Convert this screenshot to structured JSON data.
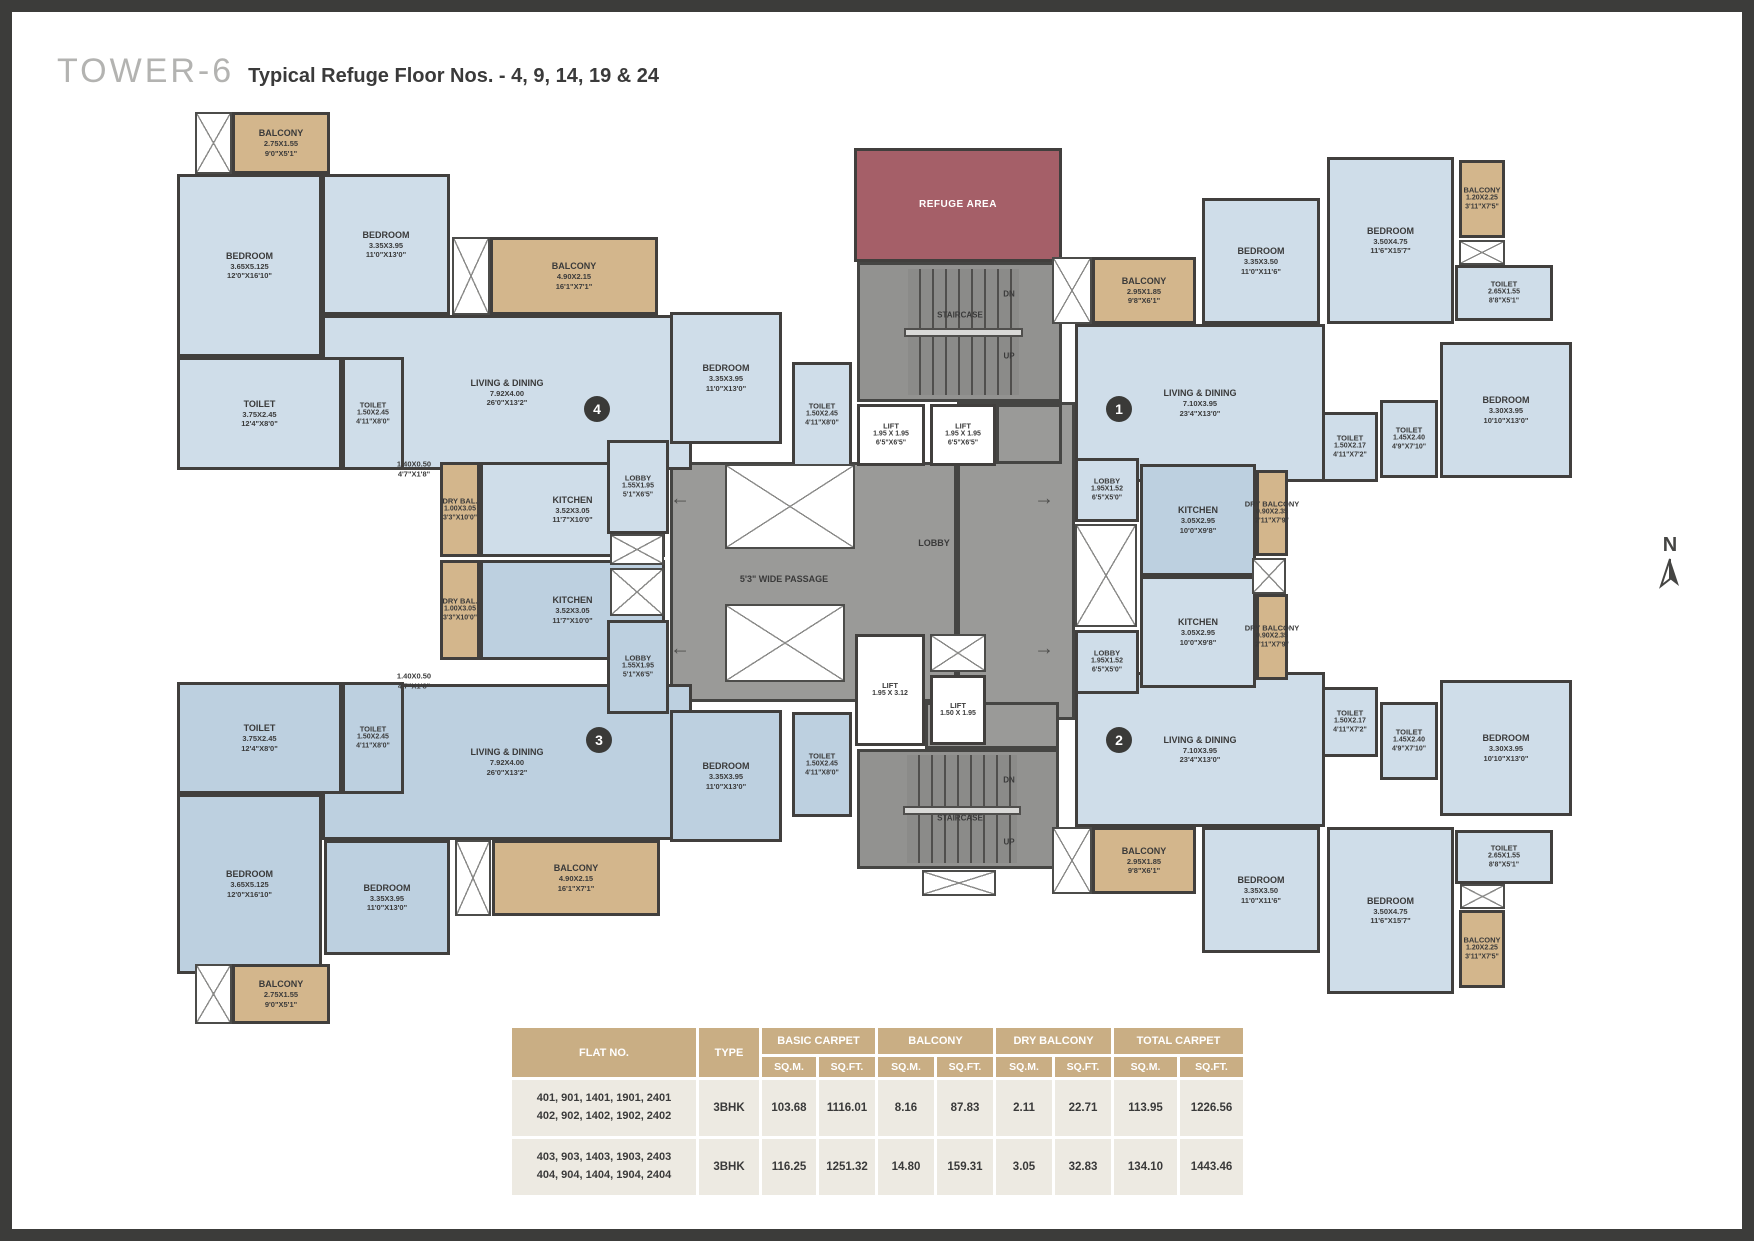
{
  "title": {
    "tower": "TOWER-6",
    "subtitle": "Typical Refuge Floor Nos. - 4, 9, 14, 19 & 24"
  },
  "compass": {
    "label": "N"
  },
  "palette": {
    "room_light": "#cfdde9",
    "room_dark": "#bdd0e0",
    "balcony": "#d3b68c",
    "refuge": "#a55f68",
    "lobby_gray": "#9a9a98",
    "wall": "#413f3d",
    "table_header": "#c9ae84",
    "table_cell": "#edeae2"
  },
  "plan": {
    "shapes": [
      {
        "id": "central-passage",
        "t": "gray",
        "x": 658,
        "y": 450,
        "w": 287,
        "h": 240
      },
      {
        "id": "lobby-column",
        "t": "gray",
        "x": 945,
        "y": 390,
        "w": 118,
        "h": 318
      },
      {
        "id": "gray-patch-lift",
        "t": "gray",
        "x": 984,
        "y": 392,
        "w": 66,
        "h": 60
      },
      {
        "id": "gray-patch-lower",
        "t": "gray",
        "x": 913,
        "y": 690,
        "w": 134,
        "h": 47
      },
      {
        "id": "staircase-top",
        "t": "stair",
        "x": 845,
        "y": 250,
        "w": 205,
        "h": 140
      },
      {
        "id": "staircase-bottom",
        "t": "stair",
        "x": 845,
        "y": 737,
        "w": 202,
        "h": 120
      },
      {
        "id": "refuge-area",
        "t": "ref",
        "n": "REFUGE AREA",
        "x": 842,
        "y": 136,
        "w": 208,
        "h": 114
      },
      {
        "id": "living-4",
        "t": "a",
        "n": "LIVING & DINING",
        "d1": "7.92X4.00",
        "d2": "26'0\"X13'2\"",
        "x": 310,
        "y": 303,
        "w": 370,
        "h": 155
      },
      {
        "id": "living-3",
        "t": "b",
        "n": "LIVING & DINING",
        "d1": "7.92X4.00",
        "d2": "26'0\"X13'2\"",
        "x": 310,
        "y": 672,
        "w": 370,
        "h": 156
      },
      {
        "id": "living-1",
        "t": "a",
        "n": "LIVING & DINING",
        "d1": "7.10X3.95",
        "d2": "23'4\"X13'0\"",
        "x": 1063,
        "y": 312,
        "w": 250,
        "h": 158
      },
      {
        "id": "living-2",
        "t": "a",
        "n": "LIVING & DINING",
        "d1": "7.10X3.95",
        "d2": "23'4\"X13'0\"",
        "x": 1063,
        "y": 660,
        "w": 250,
        "h": 155
      },
      {
        "id": "balcony-4a",
        "t": "bal",
        "n": "BALCONY",
        "d1": "2.75X1.55",
        "d2": "9'0\"X5'1\"",
        "x": 220,
        "y": 100,
        "w": 98,
        "h": 62
      },
      {
        "id": "bedroom-4a",
        "t": "a",
        "n": "BEDROOM",
        "d1": "3.65X5.125",
        "d2": "12'0\"X16'10\"",
        "x": 165,
        "y": 162,
        "w": 145,
        "h": 183
      },
      {
        "id": "bedroom-4b",
        "t": "a",
        "n": "BEDROOM",
        "d1": "3.35X3.95",
        "d2": "11'0\"X13'0\"",
        "x": 310,
        "y": 162,
        "w": 128,
        "h": 141
      },
      {
        "id": "balcony-4b",
        "t": "bal",
        "n": "BALCONY",
        "d1": "4.90X2.15",
        "d2": "16'1\"X7'1\"",
        "x": 478,
        "y": 225,
        "w": 168,
        "h": 78
      },
      {
        "id": "toilet-4a",
        "t": "a",
        "n": "TOILET",
        "d1": "3.75X2.45",
        "d2": "12'4\"X8'0\"",
        "x": 165,
        "y": 345,
        "w": 165,
        "h": 113
      },
      {
        "id": "toilet-4b",
        "t": "a",
        "sm": 1,
        "n": "TOILET",
        "d1": "1.50X2.45",
        "d2": "4'11\"X8'0\"",
        "x": 330,
        "y": 345,
        "w": 62,
        "h": 113
      },
      {
        "id": "drybal-4",
        "t": "bal",
        "sm": 1,
        "n": "DRY BAL.",
        "d1": "1.00X3.05",
        "d2": "3'3\"X10'0\"",
        "x": 428,
        "y": 450,
        "w": 40,
        "h": 95
      },
      {
        "id": "kitchen-4",
        "t": "a",
        "n": "KITCHEN",
        "d1": "3.52X3.05",
        "d2": "11'7\"X10'0\"",
        "x": 468,
        "y": 450,
        "w": 185,
        "h": 95
      },
      {
        "id": "lobby-4",
        "t": "a",
        "sm": 1,
        "n": "LOBBY",
        "d1": "1.55X1.95",
        "d2": "5'1\"X6'5\"",
        "x": 595,
        "y": 428,
        "w": 62,
        "h": 94
      },
      {
        "id": "bedroom-4c",
        "t": "a",
        "n": "BEDROOM",
        "d1": "3.35X3.95",
        "d2": "11'0\"X13'0\"",
        "x": 658,
        "y": 300,
        "w": 112,
        "h": 132
      },
      {
        "id": "toilet-4c",
        "t": "a",
        "sm": 1,
        "n": "TOILET",
        "d1": "1.50X2.45",
        "d2": "4'11\"X8'0\"",
        "x": 780,
        "y": 350,
        "w": 60,
        "h": 105
      },
      {
        "id": "toilet-3a",
        "t": "b",
        "n": "TOILET",
        "d1": "3.75X2.45",
        "d2": "12'4\"X8'0\"",
        "x": 165,
        "y": 670,
        "w": 165,
        "h": 112
      },
      {
        "id": "toilet-3b",
        "t": "b",
        "sm": 1,
        "n": "TOILET",
        "d1": "1.50X2.45",
        "d2": "4'11\"X8'0\"",
        "x": 330,
        "y": 670,
        "w": 62,
        "h": 112
      },
      {
        "id": "drybal-3",
        "t": "bal",
        "sm": 1,
        "n": "DRY BAL.",
        "d1": "1.00X3.05",
        "d2": "3'3\"X10'0\"",
        "x": 428,
        "y": 548,
        "w": 40,
        "h": 100
      },
      {
        "id": "kitchen-3",
        "t": "b",
        "n": "KITCHEN",
        "d1": "3.52X3.05",
        "d2": "11'7\"X10'0\"",
        "x": 468,
        "y": 548,
        "w": 185,
        "h": 100
      },
      {
        "id": "lobby-3",
        "t": "b",
        "sm": 1,
        "n": "LOBBY",
        "d1": "1.55X1.95",
        "d2": "5'1\"X6'5\"",
        "x": 595,
        "y": 608,
        "w": 62,
        "h": 94
      },
      {
        "id": "bedroom-3c",
        "t": "b",
        "n": "BEDROOM",
        "d1": "3.35X3.95",
        "d2": "11'0\"X13'0\"",
        "x": 658,
        "y": 698,
        "w": 112,
        "h": 132
      },
      {
        "id": "toilet-3c",
        "t": "b",
        "sm": 1,
        "n": "TOILET",
        "d1": "1.50X2.45",
        "d2": "4'11\"X8'0\"",
        "x": 780,
        "y": 700,
        "w": 60,
        "h": 105
      },
      {
        "id": "bedroom-3a",
        "t": "b",
        "n": "BEDROOM",
        "d1": "3.65X5.125",
        "d2": "12'0\"X16'10\"",
        "x": 165,
        "y": 782,
        "w": 145,
        "h": 180
      },
      {
        "id": "bedroom-3b",
        "t": "b",
        "n": "BEDROOM",
        "d1": "3.35X3.95",
        "d2": "11'0\"X13'0\"",
        "x": 312,
        "y": 828,
        "w": 126,
        "h": 115
      },
      {
        "id": "balcony-3b",
        "t": "bal",
        "n": "BALCONY",
        "d1": "4.90X2.15",
        "d2": "16'1\"X7'1\"",
        "x": 480,
        "y": 828,
        "w": 168,
        "h": 76
      },
      {
        "id": "balcony-3a",
        "t": "bal",
        "n": "BALCONY",
        "d1": "2.75X1.55",
        "d2": "9'0\"X5'1\"",
        "x": 220,
        "y": 952,
        "w": 98,
        "h": 60
      },
      {
        "id": "balcony-1a",
        "t": "bal",
        "n": "BALCONY",
        "d1": "2.95X1.85",
        "d2": "9'8\"X6'1\"",
        "x": 1080,
        "y": 245,
        "w": 104,
        "h": 67
      },
      {
        "id": "bedroom-1a",
        "t": "a",
        "n": "BEDROOM",
        "d1": "3.35X3.50",
        "d2": "11'0\"X11'6\"",
        "x": 1190,
        "y": 186,
        "w": 118,
        "h": 126
      },
      {
        "id": "bedroom-1b",
        "t": "a",
        "n": "BEDROOM",
        "d1": "3.50X4.75",
        "d2": "11'6\"X15'7\"",
        "x": 1315,
        "y": 145,
        "w": 127,
        "h": 167
      },
      {
        "id": "balcony-1b",
        "t": "bal",
        "sm": 1,
        "n": "BALCONY",
        "d1": "1.20X2.25",
        "d2": "3'11\"X7'5\"",
        "x": 1447,
        "y": 148,
        "w": 46,
        "h": 78
      },
      {
        "id": "toilet-1c",
        "t": "a",
        "sm": 1,
        "n": "TOILET",
        "d1": "2.65X1.55",
        "d2": "8'8\"X5'1\"",
        "x": 1443,
        "y": 253,
        "w": 98,
        "h": 56
      },
      {
        "id": "toilet-1a",
        "t": "a",
        "sm": 1,
        "n": "TOILET",
        "d1": "1.50X2.17",
        "d2": "4'11\"X7'2\"",
        "x": 1310,
        "y": 400,
        "w": 56,
        "h": 70
      },
      {
        "id": "toilet-1b",
        "t": "a",
        "sm": 1,
        "n": "TOILET",
        "d1": "1.45X2.40",
        "d2": "4'9\"X7'10\"",
        "x": 1368,
        "y": 388,
        "w": 58,
        "h": 78
      },
      {
        "id": "bedroom-1c",
        "t": "a",
        "n": "BEDROOM",
        "d1": "3.30X3.95",
        "d2": "10'10\"X13'0\"",
        "x": 1428,
        "y": 330,
        "w": 132,
        "h": 136
      },
      {
        "id": "kitchen-1",
        "t": "b",
        "n": "KITCHEN",
        "d1": "3.05X2.95",
        "d2": "10'0\"X9'8\"",
        "x": 1128,
        "y": 452,
        "w": 116,
        "h": 112
      },
      {
        "id": "lobby-1",
        "t": "a",
        "sm": 1,
        "n": "LOBBY",
        "d1": "1.95X1.52",
        "d2": "6'5\"X5'0\"",
        "x": 1063,
        "y": 446,
        "w": 64,
        "h": 64
      },
      {
        "id": "drybal-1",
        "t": "bal",
        "sm": 1,
        "n": "DRY BALCONY",
        "d1": "0.90X2.35",
        "d2": "2'11\"X7'9\"",
        "x": 1244,
        "y": 458,
        "w": 32,
        "h": 86
      },
      {
        "id": "kitchen-2",
        "t": "a",
        "n": "KITCHEN",
        "d1": "3.05X2.95",
        "d2": "10'0\"X9'8\"",
        "x": 1128,
        "y": 564,
        "w": 116,
        "h": 112
      },
      {
        "id": "lobby-2",
        "t": "a",
        "sm": 1,
        "n": "LOBBY",
        "d1": "1.95X1.52",
        "d2": "6'5\"X5'0\"",
        "x": 1063,
        "y": 618,
        "w": 64,
        "h": 64
      },
      {
        "id": "drybal-2",
        "t": "bal",
        "sm": 1,
        "n": "DRY BALCONY",
        "d1": "0.90X2.35",
        "d2": "2'11\"X7'9\"",
        "x": 1244,
        "y": 582,
        "w": 32,
        "h": 86
      },
      {
        "id": "toilet-2a",
        "t": "a",
        "sm": 1,
        "n": "TOILET",
        "d1": "1.50X2.17",
        "d2": "4'11\"X7'2\"",
        "x": 1310,
        "y": 675,
        "w": 56,
        "h": 70
      },
      {
        "id": "toilet-2b",
        "t": "a",
        "sm": 1,
        "n": "TOILET",
        "d1": "1.45X2.40",
        "d2": "4'9\"X7'10\"",
        "x": 1368,
        "y": 690,
        "w": 58,
        "h": 78
      },
      {
        "id": "bedroom-2c",
        "t": "a",
        "n": "BEDROOM",
        "d1": "3.30X3.95",
        "d2": "10'10\"X13'0\"",
        "x": 1428,
        "y": 668,
        "w": 132,
        "h": 136
      },
      {
        "id": "balcony-2a",
        "t": "bal",
        "n": "BALCONY",
        "d1": "2.95X1.85",
        "d2": "9'8\"X6'1\"",
        "x": 1080,
        "y": 815,
        "w": 104,
        "h": 67
      },
      {
        "id": "bedroom-2a",
        "t": "a",
        "n": "BEDROOM",
        "d1": "3.35X3.50",
        "d2": "11'0\"X11'6\"",
        "x": 1190,
        "y": 815,
        "w": 118,
        "h": 126
      },
      {
        "id": "bedroom-2b",
        "t": "a",
        "n": "BEDROOM",
        "d1": "3.50X4.75",
        "d2": "11'6\"X15'7\"",
        "x": 1315,
        "y": 815,
        "w": 127,
        "h": 167
      },
      {
        "id": "toilet-2c",
        "t": "a",
        "sm": 1,
        "n": "TOILET",
        "d1": "2.65X1.55",
        "d2": "8'8\"X5'1\"",
        "x": 1443,
        "y": 818,
        "w": 98,
        "h": 54
      },
      {
        "id": "balcony-2b",
        "t": "bal",
        "sm": 1,
        "n": "BALCONY",
        "d1": "1.20X2.25",
        "d2": "3'11\"X7'5\"",
        "x": 1447,
        "y": 898,
        "w": 46,
        "h": 78
      },
      {
        "id": "lift-1",
        "t": "lift",
        "sm": 1,
        "n": "LIFT",
        "d1": "1.95 X 1.95",
        "d2": "6'5\"X6'5\"",
        "x": 845,
        "y": 392,
        "w": 68,
        "h": 62
      },
      {
        "id": "lift-2",
        "t": "lift",
        "sm": 1,
        "n": "LIFT",
        "d1": "1.95 X 1.95",
        "d2": "6'5\"X6'5\"",
        "x": 918,
        "y": 392,
        "w": 66,
        "h": 62
      },
      {
        "id": "lift-3",
        "t": "lift",
        "sm": 1,
        "n": "LIFT",
        "d1": "1.95 X 3.12",
        "x": 843,
        "y": 622,
        "w": 70,
        "h": 112
      },
      {
        "id": "lift-4",
        "t": "lift",
        "sm": 1,
        "n": "LIFT",
        "d1": "1.50 X 1.95",
        "x": 918,
        "y": 663,
        "w": 56,
        "h": 70
      }
    ],
    "ducts": [
      {
        "x": 183,
        "y": 100,
        "w": 37,
        "h": 62
      },
      {
        "x": 440,
        "y": 225,
        "w": 38,
        "h": 78
      },
      {
        "x": 598,
        "y": 522,
        "w": 54,
        "h": 31
      },
      {
        "x": 598,
        "y": 556,
        "w": 54,
        "h": 48
      },
      {
        "x": 713,
        "y": 452,
        "w": 130,
        "h": 85
      },
      {
        "x": 713,
        "y": 592,
        "w": 120,
        "h": 78
      },
      {
        "x": 918,
        "y": 622,
        "w": 56,
        "h": 38
      },
      {
        "x": 910,
        "y": 858,
        "w": 74,
        "h": 26
      },
      {
        "x": 1040,
        "y": 245,
        "w": 40,
        "h": 67
      },
      {
        "x": 1447,
        "y": 228,
        "w": 46,
        "h": 25
      },
      {
        "x": 1063,
        "y": 512,
        "w": 62,
        "h": 103
      },
      {
        "x": 1240,
        "y": 546,
        "w": 34,
        "h": 36
      },
      {
        "x": 1448,
        "y": 872,
        "w": 45,
        "h": 25
      },
      {
        "x": 1040,
        "y": 815,
        "w": 40,
        "h": 67
      },
      {
        "x": 443,
        "y": 828,
        "w": 36,
        "h": 76
      },
      {
        "x": 183,
        "y": 952,
        "w": 37,
        "h": 60
      }
    ],
    "texts": [
      {
        "s": "STAIRCASE",
        "x": 948,
        "y": 303,
        "fs": 8
      },
      {
        "s": "DN",
        "x": 997,
        "y": 282,
        "fs": 8
      },
      {
        "s": "UP",
        "x": 997,
        "y": 344,
        "fs": 8
      },
      {
        "s": "STAIRCASE",
        "x": 948,
        "y": 806,
        "fs": 8
      },
      {
        "s": "DN",
        "x": 997,
        "y": 768,
        "fs": 8
      },
      {
        "s": "UP",
        "x": 997,
        "y": 830,
        "fs": 8
      },
      {
        "s": "LOBBY",
        "x": 922,
        "y": 531,
        "fs": 9
      },
      {
        "s": "5'3\" WIDE PASSAGE",
        "x": 772,
        "y": 567,
        "fs": 9
      },
      {
        "s": "1.40X0.50",
        "x": 402,
        "y": 452,
        "fs": 7.5
      },
      {
        "s": "4'7\"X1'8\"",
        "x": 402,
        "y": 462,
        "fs": 7.5
      },
      {
        "s": "1.40X0.50",
        "x": 402,
        "y": 664,
        "fs": 7.5
      },
      {
        "s": "4'7\"X1'8\"",
        "x": 402,
        "y": 674,
        "fs": 7.5
      }
    ],
    "arrows": [
      {
        "g": "←",
        "x": 668,
        "y": 487
      },
      {
        "g": "←",
        "x": 668,
        "y": 637
      },
      {
        "g": "→",
        "x": 1032,
        "y": 487
      },
      {
        "g": "→",
        "x": 1032,
        "y": 637
      }
    ],
    "badges": [
      {
        "n": "4",
        "x": 585,
        "y": 397
      },
      {
        "n": "3",
        "x": 587,
        "y": 728
      },
      {
        "n": "1",
        "x": 1107,
        "y": 397
      },
      {
        "n": "2",
        "x": 1107,
        "y": 728
      }
    ]
  },
  "table": {
    "col_flat": "FLAT NO.",
    "col_type": "TYPE",
    "groups": [
      {
        "label": "BASIC CARPET"
      },
      {
        "label": "BALCONY"
      },
      {
        "label": "DRY BALCONY"
      },
      {
        "label": "TOTAL CARPET"
      }
    ],
    "sub_m": "SQ.M.",
    "sub_ft": "SQ.FT.",
    "rows": [
      {
        "flats": [
          "401, 901, 1401, 1901, 2401",
          "402, 902, 1402, 1902, 2402"
        ],
        "type": "3BHK",
        "values": [
          "103.68",
          "1116.01",
          "8.16",
          "87.83",
          "2.11",
          "22.71",
          "113.95",
          "1226.56"
        ]
      },
      {
        "flats": [
          "403, 903, 1403, 1903, 2403",
          "404, 904, 1404, 1904, 2404"
        ],
        "type": "3BHK",
        "values": [
          "116.25",
          "1251.32",
          "14.80",
          "159.31",
          "3.05",
          "32.83",
          "134.10",
          "1443.46"
        ]
      }
    ]
  }
}
